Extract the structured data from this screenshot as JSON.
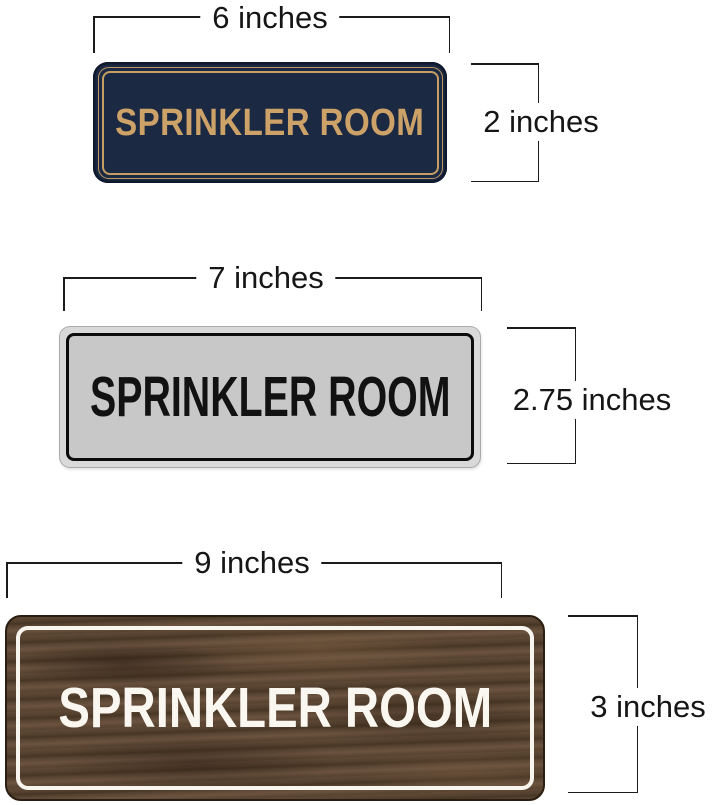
{
  "signs": [
    {
      "style": "navy-gold",
      "text": "SPRINKLER ROOM",
      "width_label": "6 inches",
      "height_label": "2 inches",
      "colors": {
        "background": "#1c2942",
        "border": "#c49e63",
        "text": "#cda268"
      }
    },
    {
      "style": "silver",
      "text": "SPRINKLER ROOM",
      "width_label": "7 inches",
      "height_label": "2.75 inches",
      "colors": {
        "background": "#c8c8c8",
        "frame": "#d9d9d9",
        "border": "#0c0c0c",
        "text": "#121212"
      }
    },
    {
      "style": "walnut-wood",
      "text": "SPRINKLER ROOM",
      "width_label": "9 inches",
      "height_label": "3 inches",
      "colors": {
        "background": "#55412f",
        "border": "#f8f5ee",
        "text": "#faf7f0"
      }
    }
  ],
  "dimensions": {
    "line_color": "#1b1b1b"
  }
}
